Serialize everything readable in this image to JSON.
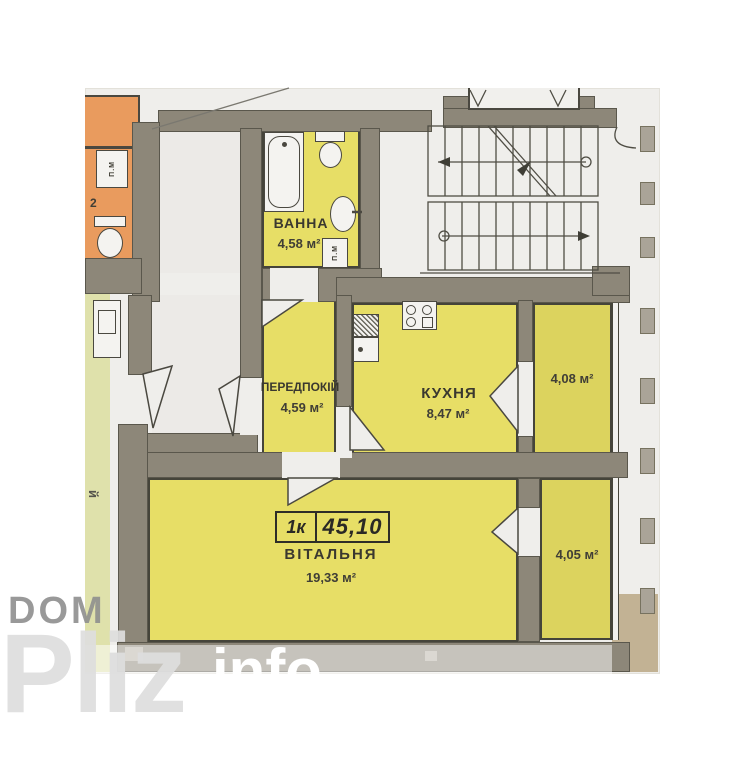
{
  "watermark": {
    "top": "DOM",
    "main": "Pliz",
    "suffix": "info"
  },
  "plan": {
    "unit_box": {
      "rooms": "1к",
      "total_area": "45,10"
    },
    "rooms": {
      "bathroom": {
        "label": "ВАННА",
        "area": "4,58 м²"
      },
      "hallway": {
        "label": "ПЕРЕДПОКІЙ",
        "area": "4,59 м²"
      },
      "kitchen": {
        "label": "КУХНЯ",
        "area": "8,47 м²"
      },
      "living": {
        "label": "ВІТАЛЬНЯ",
        "area": "19,33 м²"
      },
      "loggia_top": {
        "area": "4,08 м²"
      },
      "loggia_bottom": {
        "area": "4,05 м²"
      }
    },
    "annotations": {
      "washer_bath": "П.М",
      "washer_neighbor": "П.М",
      "neighbor_number": "2",
      "edge_letter": "й"
    },
    "colors": {
      "room_fill": "#e7de66",
      "loggia_fill": "#dcd35e",
      "wall_fill": "#8d8779",
      "neighbor_orange": "#e99b5e",
      "neighbor_green": "#dfe1ab",
      "photo_bg": "#efeeeb"
    }
  }
}
